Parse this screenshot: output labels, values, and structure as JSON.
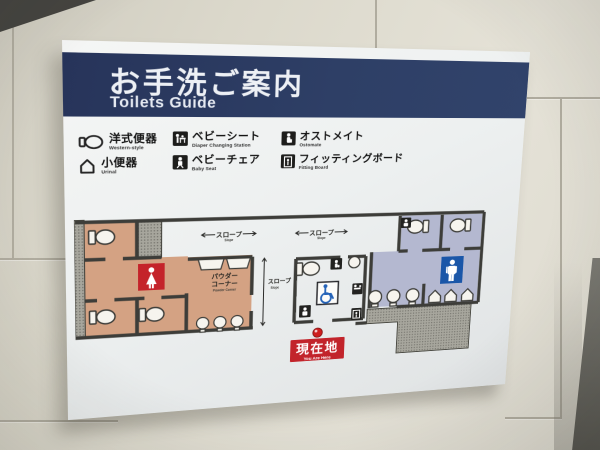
{
  "sign": {
    "header": {
      "title_jp": "お手洗ご案内",
      "title_en": "Toilets Guide"
    },
    "legend": {
      "items": [
        {
          "jp": "洋式便器",
          "en": "Western-style",
          "icon": "western-toilet-icon"
        },
        {
          "jp": "ベビーシート",
          "en": "Diaper Changing Station",
          "icon": "diaper-changing-icon"
        },
        {
          "jp": "オストメイト",
          "en": "Ostomate",
          "icon": "ostomate-icon"
        },
        {
          "jp": "小便器",
          "en": "Urinal",
          "icon": "urinal-icon"
        },
        {
          "jp": "ベビーチェア",
          "en": "Baby Seat",
          "icon": "baby-chair-icon"
        },
        {
          "jp": "フィッティングボード",
          "en": "Fitting Board",
          "icon": "fitting-board-icon"
        }
      ]
    },
    "plan": {
      "labels": {
        "slope_jp": "スロープ",
        "slope_en": "Slope",
        "powder_line1": "パウダー",
        "powder_line2": "コーナー",
        "powder_en": "Powder Corner",
        "here_jp": "現在地",
        "here_en": "You Are Here"
      },
      "colors": {
        "womens_area": "#d4a283",
        "mens_area": "#b4b8d0",
        "women_sign_red": "#c4232a",
        "men_sign_blue": "#1a56a8",
        "here_red": "#c2242b",
        "wheelchair_blue": "#2563b8",
        "wall": "#3d3d39",
        "header_navy": "#2e3f66"
      }
    }
  }
}
